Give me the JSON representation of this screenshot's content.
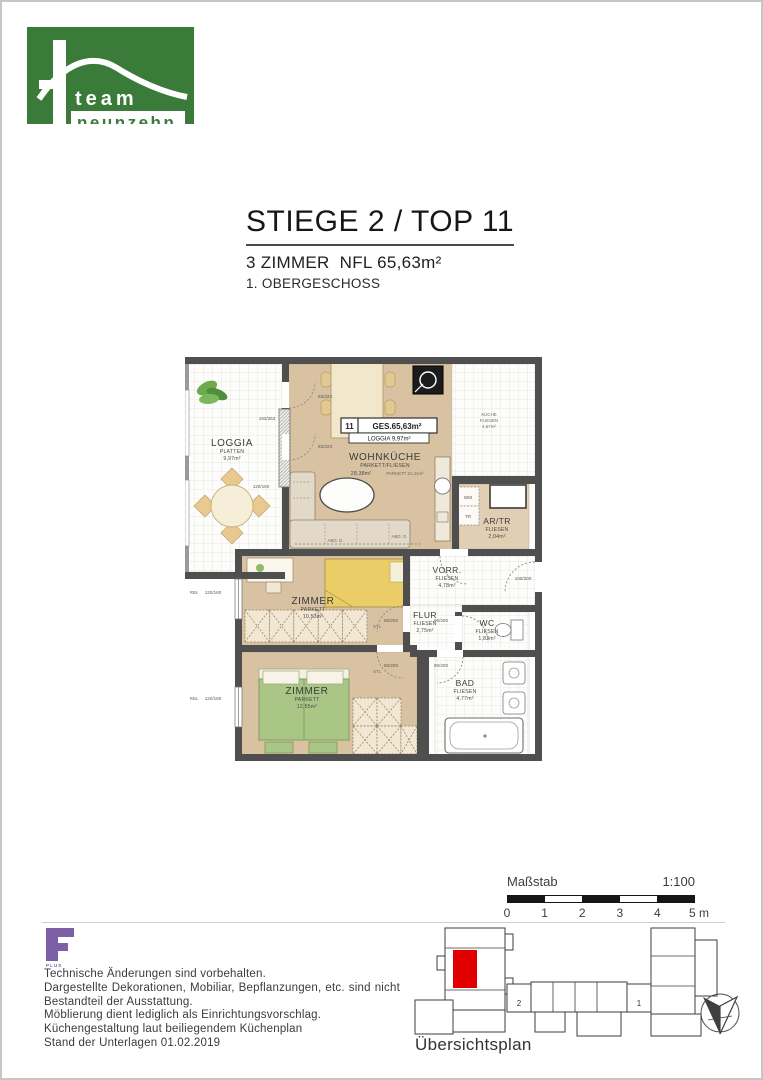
{
  "logo": {
    "line1": "team",
    "line2": "neunzehn"
  },
  "header": {
    "title": "STIEGE 2 / TOP 11",
    "subtitle": "3 ZIMMER  NFL 65,63m²",
    "floor": "1. OBERGESCHOSS"
  },
  "plan": {
    "unit_number": "11",
    "unit_total": "GES.65,63m²",
    "unit_loggia": "LOGGIA 9,97m²",
    "rooms": {
      "loggia": {
        "name": "LOGGIA",
        "finish": "PLATTEN",
        "area": "9,97m²"
      },
      "wohnkueche": {
        "name": "WOHNKÜCHE",
        "finish": "PARKETT/FLIESEN",
        "area": "28,38m²",
        "area_parkett": "PARKETT 21,41m²"
      },
      "kueche": {
        "name": "KÜCHE",
        "finish": "FLIESEN",
        "area": "4,57m²"
      },
      "artr": {
        "name": "AR/TR",
        "finish": "FLIESEN",
        "area": "2,04m²"
      },
      "vorraum": {
        "name": "VORR.",
        "finish": "FLIESEN",
        "area": "4,78m²"
      },
      "flur": {
        "name": "FLUR",
        "finish": "FLIESEN",
        "area": "2,75m²"
      },
      "wc": {
        "name": "WC",
        "finish": "FLIESEN",
        "area": "1,83m²"
      },
      "bad": {
        "name": "BAD",
        "finish": "FLIESEN",
        "area": "4,77m²"
      },
      "zimmer1": {
        "name": "ZIMMER",
        "finish": "PARKETT",
        "area": "10,53m²"
      },
      "zimmer2": {
        "name": "ZIMMER",
        "finish": "PARKETT",
        "area": "12,55m²"
      }
    },
    "appliances": {
      "wm": "WM",
      "tr": "TR"
    },
    "dims": {
      "door_loggia": "83/223",
      "door_interior": "80/200",
      "door_entry": "100/200",
      "window_small": "120/160",
      "window_large": "193/263",
      "stl": "STL",
      "rbl": "RBL",
      "ceiling": "ABG. D"
    }
  },
  "scalebar": {
    "label": "Maßstab",
    "ratio": "1:100",
    "ticks": [
      "0",
      "1",
      "2",
      "3",
      "4",
      "5 m"
    ]
  },
  "overview": {
    "label": "Übersichtsplan",
    "stair2": "2",
    "stair1": "1"
  },
  "footer": {
    "logo_sub": "PLUS",
    "lines": [
      "Technische Änderungen sind vorbehalten.",
      "Dargestellte Dekorationen, Mobiliar, Bepflanzungen, etc. sind nicht",
      "Bestandteil der Ausstattung.",
      "Möblierung dient lediglich als Einrichtungsvorschlag.",
      "Küchengestaltung laut beiliegendem Küchenplan",
      "Stand der Unterlagen 01.02.2019"
    ]
  },
  "colors": {
    "brand_green": "#3a7b39",
    "unit_red": "#e10000",
    "fplus_purple": "#7d5fa7",
    "plan_tan": "#d9c2a2"
  }
}
